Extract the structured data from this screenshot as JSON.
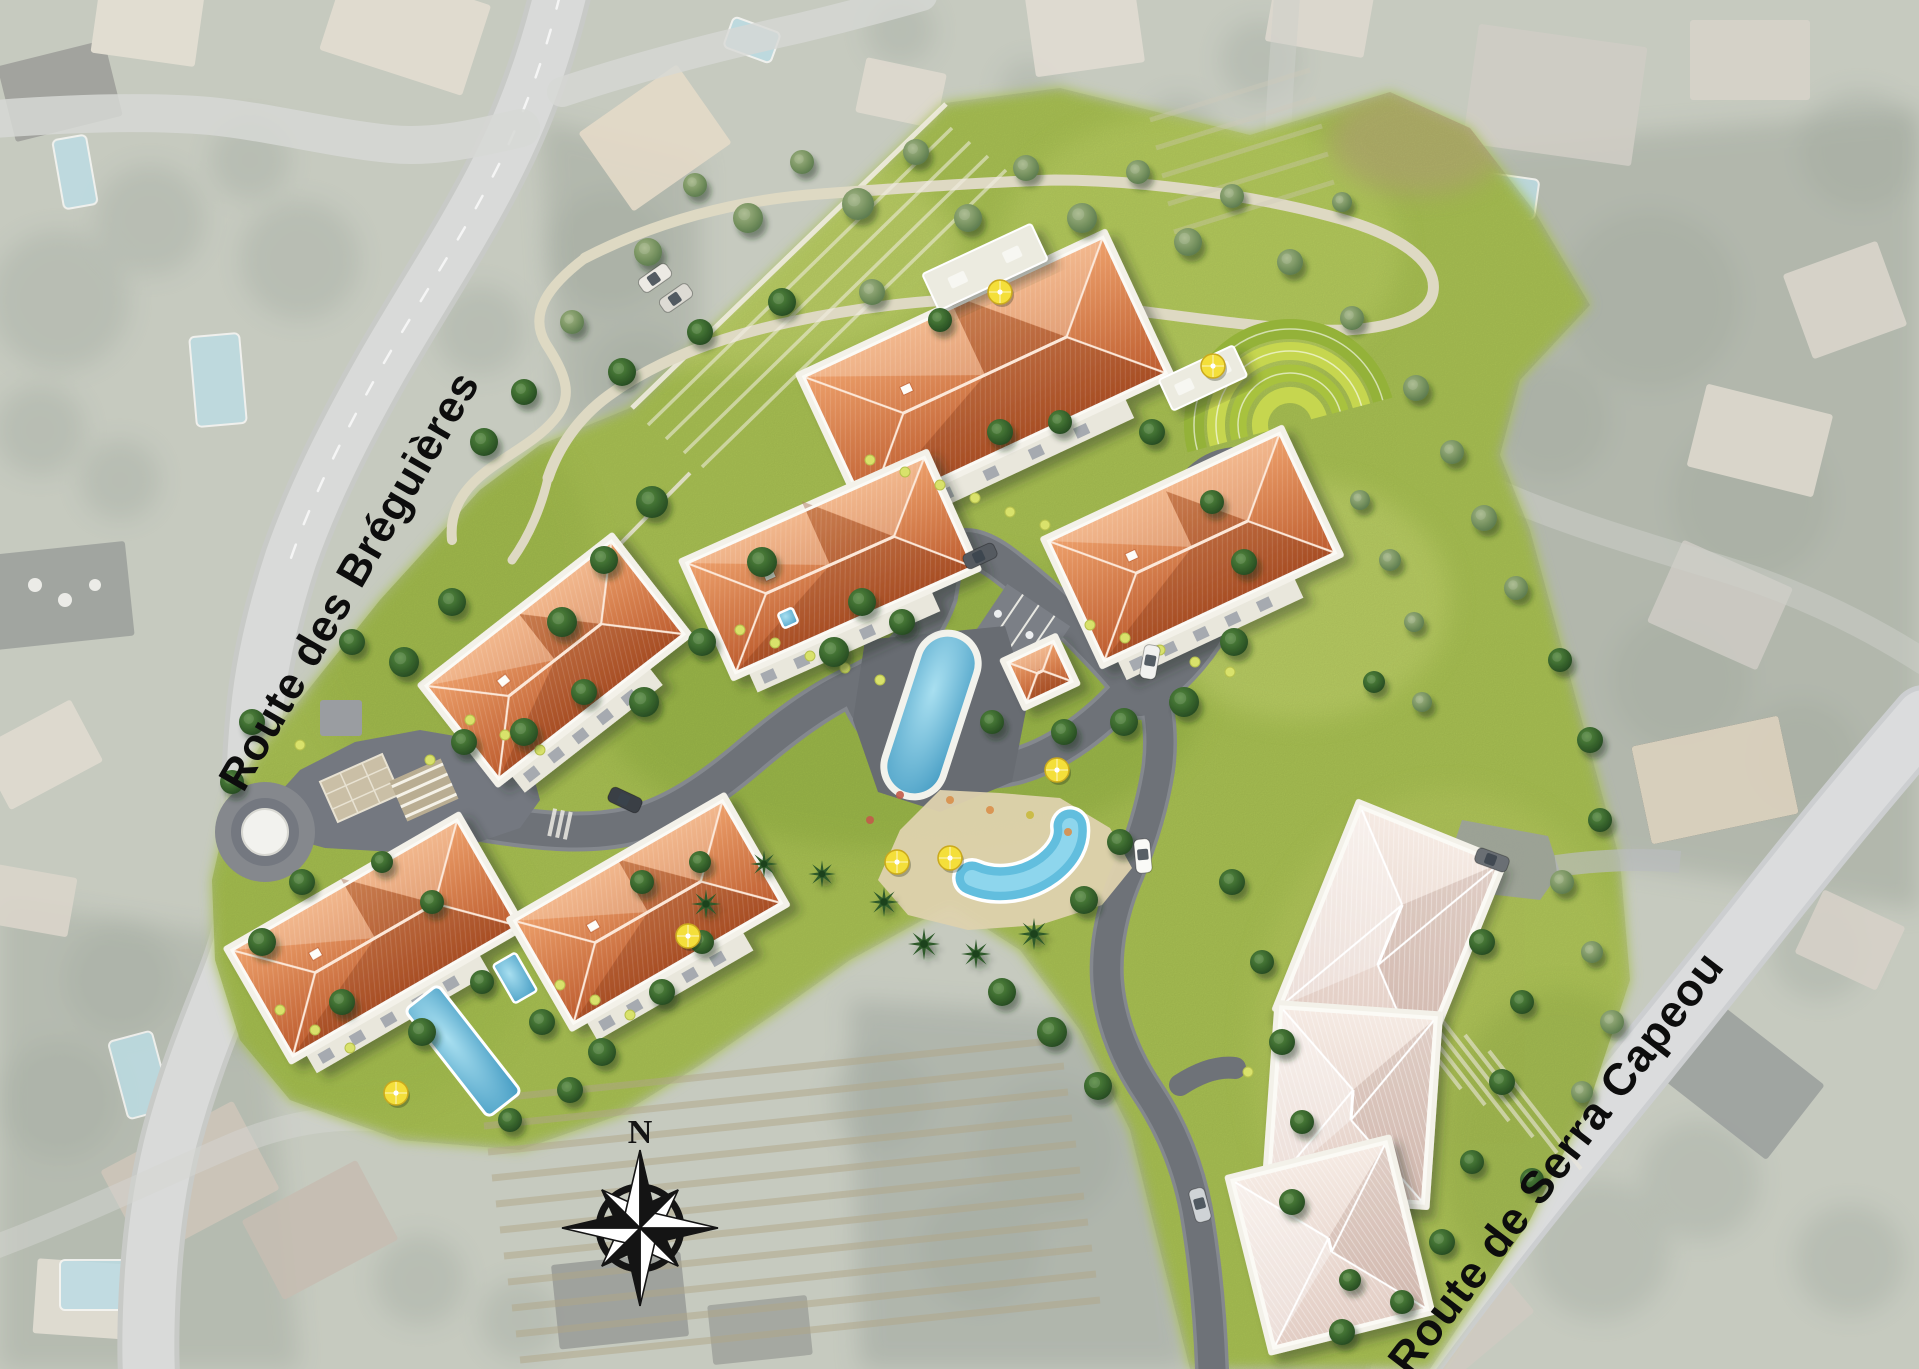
{
  "meta": {
    "type": "aerial-masterplan",
    "description": "Rendered residential development site plan composited over a faded aerial photograph"
  },
  "labels": {
    "road_1": "Route des Bréguières",
    "road_2": "Route de Serra Capeou",
    "compass_north": "N"
  },
  "colors": {
    "site_grass": "#a9c153",
    "roof_orange": "#cf6f3e",
    "roof_pale": "#ecdcd4",
    "internal_road": "#6e7278",
    "public_road": "#c6c8c6",
    "pool_water": "#5fb4d6",
    "path_beige": "#ded9c3",
    "label_text": "#0d0d0d"
  },
  "site": {
    "orange_roof_buildings": 6,
    "pale_roof_buildings": 3,
    "pavilions": 1,
    "pool_names": [
      "lap-pool",
      "leisure-pool",
      "villa-pool",
      "villa-spa",
      "terrace-spa"
    ],
    "features": [
      "roundabout",
      "entrance-plaza",
      "turnaround-loop",
      "terraced-ring-garden",
      "parking-bays",
      "serpentine-path",
      "palm-beach",
      "compass-rose"
    ]
  },
  "buildings": [
    {
      "id": "building-a",
      "x": 985,
      "y": 375,
      "w": 330,
      "h": 150,
      "rot": -25,
      "roof": "orange"
    },
    {
      "id": "building-b",
      "x": 830,
      "y": 565,
      "w": 260,
      "h": 120,
      "rot": -24,
      "roof": "orange"
    },
    {
      "id": "building-c",
      "x": 555,
      "y": 660,
      "w": 235,
      "h": 118,
      "rot": -38,
      "roof": "orange"
    },
    {
      "id": "building-d",
      "x": 1192,
      "y": 547,
      "w": 255,
      "h": 132,
      "rot": -25,
      "roof": "orange"
    },
    {
      "id": "building-e",
      "x": 375,
      "y": 938,
      "w": 260,
      "h": 122,
      "rot": -30,
      "roof": "orange"
    },
    {
      "id": "building-f",
      "x": 648,
      "y": 912,
      "w": 240,
      "h": 118,
      "rot": -30,
      "roof": "orange"
    },
    {
      "id": "pavilion",
      "x": 1040,
      "y": 672,
      "w": 50,
      "h": 44,
      "rot": -25,
      "roof": "orange"
    },
    {
      "id": "building-g1",
      "x": 1390,
      "y": 935,
      "w": 150,
      "h": 215,
      "rot": 22,
      "roof": "pale"
    },
    {
      "id": "building-g2",
      "x": 1352,
      "y": 1105,
      "w": 155,
      "h": 185,
      "rot": 4,
      "roof": "pale"
    },
    {
      "id": "building-g3",
      "x": 1330,
      "y": 1245,
      "w": 158,
      "h": 172,
      "rot": -14,
      "roof": "pale"
    },
    {
      "id": "terrace-pad-a",
      "x": 985,
      "y": 267,
      "w": 120,
      "h": 40,
      "rot": -25,
      "roof": "pad"
    },
    {
      "id": "terrace-pad-d",
      "x": 1203,
      "y": 378,
      "w": 82,
      "h": 34,
      "rot": -25,
      "roof": "pad"
    }
  ],
  "trees": [
    [
      648,
      252,
      14,
      "o"
    ],
    [
      695,
      185,
      12,
      "o"
    ],
    [
      748,
      218,
      15,
      "o"
    ],
    [
      802,
      162,
      12,
      "o"
    ],
    [
      858,
      204,
      16,
      "o"
    ],
    [
      916,
      152,
      13,
      "o"
    ],
    [
      968,
      218,
      14,
      "o"
    ],
    [
      1026,
      168,
      13,
      "o"
    ],
    [
      1082,
      218,
      15,
      "o"
    ],
    [
      1138,
      172,
      12,
      "o"
    ],
    [
      1188,
      242,
      14,
      "o"
    ],
    [
      1232,
      196,
      12,
      "o"
    ],
    [
      872,
      292,
      13,
      "o"
    ],
    [
      782,
      302,
      14,
      "d"
    ],
    [
      700,
      332,
      13,
      "d"
    ],
    [
      622,
      372,
      14,
      "d"
    ],
    [
      572,
      322,
      12,
      "o"
    ],
    [
      524,
      392,
      13,
      "d"
    ],
    [
      484,
      442,
      14,
      "d"
    ],
    [
      940,
      320,
      12,
      "d"
    ],
    [
      1290,
      262,
      13,
      "o"
    ],
    [
      1352,
      318,
      12,
      "o"
    ],
    [
      1416,
      388,
      13,
      "o"
    ],
    [
      1342,
      202,
      10,
      "o"
    ],
    [
      1452,
      452,
      12,
      "o"
    ],
    [
      1484,
      518,
      13,
      "o"
    ],
    [
      1516,
      588,
      12,
      "o"
    ],
    [
      1360,
      500,
      10,
      "o"
    ],
    [
      1390,
      560,
      11,
      "o"
    ],
    [
      1414,
      622,
      10,
      "o"
    ],
    [
      652,
      502,
      16,
      "d"
    ],
    [
      604,
      560,
      14,
      "d"
    ],
    [
      562,
      622,
      15,
      "d"
    ],
    [
      452,
      602,
      14,
      "d"
    ],
    [
      404,
      662,
      15,
      "d"
    ],
    [
      352,
      642,
      13,
      "d"
    ],
    [
      762,
      562,
      15,
      "d"
    ],
    [
      862,
      602,
      14,
      "d"
    ],
    [
      702,
      642,
      14,
      "d"
    ],
    [
      644,
      702,
      15,
      "d"
    ],
    [
      584,
      692,
      13,
      "d"
    ],
    [
      524,
      732,
      14,
      "d"
    ],
    [
      464,
      742,
      13,
      "d"
    ],
    [
      834,
      652,
      15,
      "d"
    ],
    [
      902,
      622,
      13,
      "d"
    ],
    [
      1000,
      432,
      13,
      "d"
    ],
    [
      1060,
      422,
      12,
      "d"
    ],
    [
      1152,
      432,
      13,
      "d"
    ],
    [
      1212,
      502,
      12,
      "d"
    ],
    [
      1244,
      562,
      13,
      "d"
    ],
    [
      1234,
      642,
      14,
      "d"
    ],
    [
      1184,
      702,
      15,
      "d"
    ],
    [
      1124,
      722,
      14,
      "d"
    ],
    [
      1064,
      732,
      13,
      "d"
    ],
    [
      992,
      722,
      12,
      "d"
    ],
    [
      1374,
      682,
      11,
      "d"
    ],
    [
      1422,
      702,
      10,
      "o"
    ],
    [
      1560,
      660,
      12,
      "d"
    ],
    [
      1590,
      740,
      13,
      "d"
    ],
    [
      1600,
      820,
      12,
      "d"
    ],
    [
      884,
      902,
      13,
      "p"
    ],
    [
      924,
      944,
      14,
      "p"
    ],
    [
      976,
      954,
      13,
      "p"
    ],
    [
      1034,
      934,
      14,
      "p"
    ],
    [
      822,
      874,
      12,
      "p"
    ],
    [
      764,
      864,
      12,
      "p"
    ],
    [
      706,
      904,
      13,
      "p"
    ],
    [
      1084,
      900,
      14,
      "d"
    ],
    [
      1120,
      842,
      13,
      "d"
    ],
    [
      1002,
      992,
      14,
      "d"
    ],
    [
      1052,
      1032,
      15,
      "d"
    ],
    [
      1098,
      1086,
      14,
      "d"
    ],
    [
      252,
      722,
      13,
      "d"
    ],
    [
      232,
      782,
      12,
      "d"
    ],
    [
      302,
      882,
      13,
      "d"
    ],
    [
      262,
      942,
      14,
      "d"
    ],
    [
      342,
      1002,
      13,
      "d"
    ],
    [
      422,
      1032,
      14,
      "d"
    ],
    [
      482,
      982,
      12,
      "d"
    ],
    [
      542,
      1022,
      13,
      "d"
    ],
    [
      602,
      1052,
      14,
      "d"
    ],
    [
      662,
      992,
      13,
      "d"
    ],
    [
      702,
      942,
      12,
      "d"
    ],
    [
      432,
      902,
      12,
      "d"
    ],
    [
      382,
      862,
      11,
      "d"
    ],
    [
      642,
      882,
      12,
      "d"
    ],
    [
      700,
      862,
      11,
      "d"
    ],
    [
      570,
      1090,
      13,
      "d"
    ],
    [
      510,
      1120,
      12,
      "d"
    ],
    [
      1232,
      882,
      13,
      "d"
    ],
    [
      1262,
      962,
      12,
      "d"
    ],
    [
      1282,
      1042,
      13,
      "d"
    ],
    [
      1302,
      1122,
      12,
      "d"
    ],
    [
      1292,
      1202,
      13,
      "d"
    ],
    [
      1482,
      942,
      13,
      "d"
    ],
    [
      1522,
      1002,
      12,
      "d"
    ],
    [
      1502,
      1082,
      13,
      "d"
    ],
    [
      1472,
      1162,
      12,
      "d"
    ],
    [
      1442,
      1242,
      13,
      "d"
    ],
    [
      1402,
      1302,
      12,
      "d"
    ],
    [
      1342,
      1332,
      13,
      "d"
    ],
    [
      1562,
      882,
      12,
      "o"
    ],
    [
      1592,
      952,
      11,
      "o"
    ],
    [
      1612,
      1022,
      12,
      "o"
    ],
    [
      1582,
      1092,
      11,
      "o"
    ],
    [
      1532,
      1180,
      12,
      "d"
    ],
    [
      1350,
      1280,
      11,
      "d"
    ]
  ],
  "umbrellas": [
    [
      1000,
      292
    ],
    [
      1213,
      366
    ],
    [
      1057,
      770
    ],
    [
      897,
      862
    ],
    [
      950,
      858
    ],
    [
      688,
      936
    ],
    [
      396,
      1093
    ]
  ],
  "cars": [
    [
      980,
      556,
      -25,
      "#555a60"
    ],
    [
      1150,
      662,
      100,
      "#f1f1ef"
    ],
    [
      1143,
      856,
      85,
      "#fafaf7"
    ],
    [
      1200,
      1205,
      75,
      "#cfd3d6"
    ],
    [
      1492,
      860,
      20,
      "#6a6f74"
    ],
    [
      625,
      800,
      25,
      "#3a3f45"
    ],
    [
      655,
      278,
      -35,
      "#eceae4"
    ],
    [
      676,
      298,
      -35,
      "#dddbd4"
    ]
  ],
  "washed_pools": [
    [
      75,
      172,
      34,
      70,
      -10
    ],
    [
      218,
      380,
      50,
      90,
      -5
    ],
    [
      140,
      1075,
      45,
      80,
      -15
    ],
    [
      95,
      1285,
      70,
      50,
      0
    ],
    [
      1502,
      195,
      70,
      40,
      8
    ],
    [
      752,
      40,
      50,
      32,
      20
    ]
  ],
  "small_pools": [
    [
      788,
      618,
      16,
      16,
      -24
    ],
    [
      515,
      978,
      26,
      44,
      -30
    ]
  ],
  "shrubs": [
    [
      870,
      460
    ],
    [
      905,
      472
    ],
    [
      940,
      485
    ],
    [
      975,
      498
    ],
    [
      1010,
      512
    ],
    [
      1045,
      525
    ],
    [
      740,
      630
    ],
    [
      775,
      643
    ],
    [
      810,
      656
    ],
    [
      845,
      668
    ],
    [
      880,
      680
    ],
    [
      1090,
      625
    ],
    [
      1125,
      638
    ],
    [
      1160,
      650
    ],
    [
      1195,
      662
    ],
    [
      1230,
      672
    ],
    [
      470,
      720
    ],
    [
      505,
      735
    ],
    [
      540,
      750
    ],
    [
      280,
      1010
    ],
    [
      315,
      1030
    ],
    [
      350,
      1048
    ],
    [
      560,
      985
    ],
    [
      595,
      1000
    ],
    [
      630,
      1015
    ],
    [
      300,
      745
    ],
    [
      430,
      760
    ],
    [
      1248,
      1072
    ]
  ],
  "flowers": [
    [
      950,
      800,
      "#d98f4a"
    ],
    [
      990,
      810,
      "#d98f4a"
    ],
    [
      1030,
      815,
      "#c9b93e"
    ],
    [
      900,
      795,
      "#c25b4a"
    ],
    [
      870,
      820,
      "#c25b4a"
    ],
    [
      1068,
      832,
      "#d98f4a"
    ]
  ],
  "line_rows": [
    {
      "x1": 480,
      "y1": 1100,
      "x2": 1060,
      "y2": 1040,
      "n": 11,
      "dx": 4,
      "dy": 26,
      "color": "#b0a689",
      "w": 7,
      "op": 0.5
    },
    {
      "x1": 648,
      "y1": 425,
      "x2": 952,
      "y2": 128,
      "n": 4,
      "dx": 18,
      "dy": 14,
      "color": "#f2efe2",
      "w": 3.5,
      "op": 0.55
    },
    {
      "x1": 1345,
      "y1": 955,
      "x2": 1437,
      "y2": 1073,
      "n": 7,
      "dx": 24,
      "dy": 16,
      "color": "#ece8dc",
      "w": 4,
      "op": 0.6
    },
    {
      "x1": 1150,
      "y1": 120,
      "x2": 1310,
      "y2": 70,
      "n": 5,
      "dx": 6,
      "dy": 28,
      "color": "#cfc9b8",
      "w": 5,
      "op": 0.35
    }
  ],
  "tree_blobs": [
    [
      60,
      300,
      70
    ],
    [
      150,
      220,
      55
    ],
    [
      300,
      260,
      60
    ],
    [
      480,
      330,
      45
    ],
    [
      610,
      250,
      60
    ],
    [
      640,
      380,
      50
    ],
    [
      120,
      480,
      40
    ],
    [
      40,
      430,
      45
    ],
    [
      250,
      160,
      40
    ],
    [
      1650,
      300,
      90
    ],
    [
      1750,
      500,
      80
    ],
    [
      1550,
      420,
      60
    ],
    [
      1680,
      680,
      70
    ],
    [
      1800,
      760,
      60
    ],
    [
      1450,
      620,
      50
    ],
    [
      1050,
      1150,
      70
    ],
    [
      980,
      1250,
      60
    ],
    [
      880,
      1100,
      50
    ],
    [
      120,
      980,
      55
    ],
    [
      60,
      1100,
      60
    ],
    [
      230,
      1010,
      40
    ],
    [
      1600,
      1250,
      70
    ],
    [
      1700,
      1180,
      60
    ],
    [
      1850,
      1260,
      55
    ],
    [
      420,
      1280,
      45
    ],
    [
      520,
      1320,
      40
    ],
    [
      1260,
      60,
      40
    ],
    [
      1180,
      130,
      35
    ],
    [
      900,
      30,
      35
    ],
    [
      1030,
      90,
      30
    ],
    [
      1860,
      150,
      60
    ],
    [
      1820,
      950,
      50
    ]
  ]
}
